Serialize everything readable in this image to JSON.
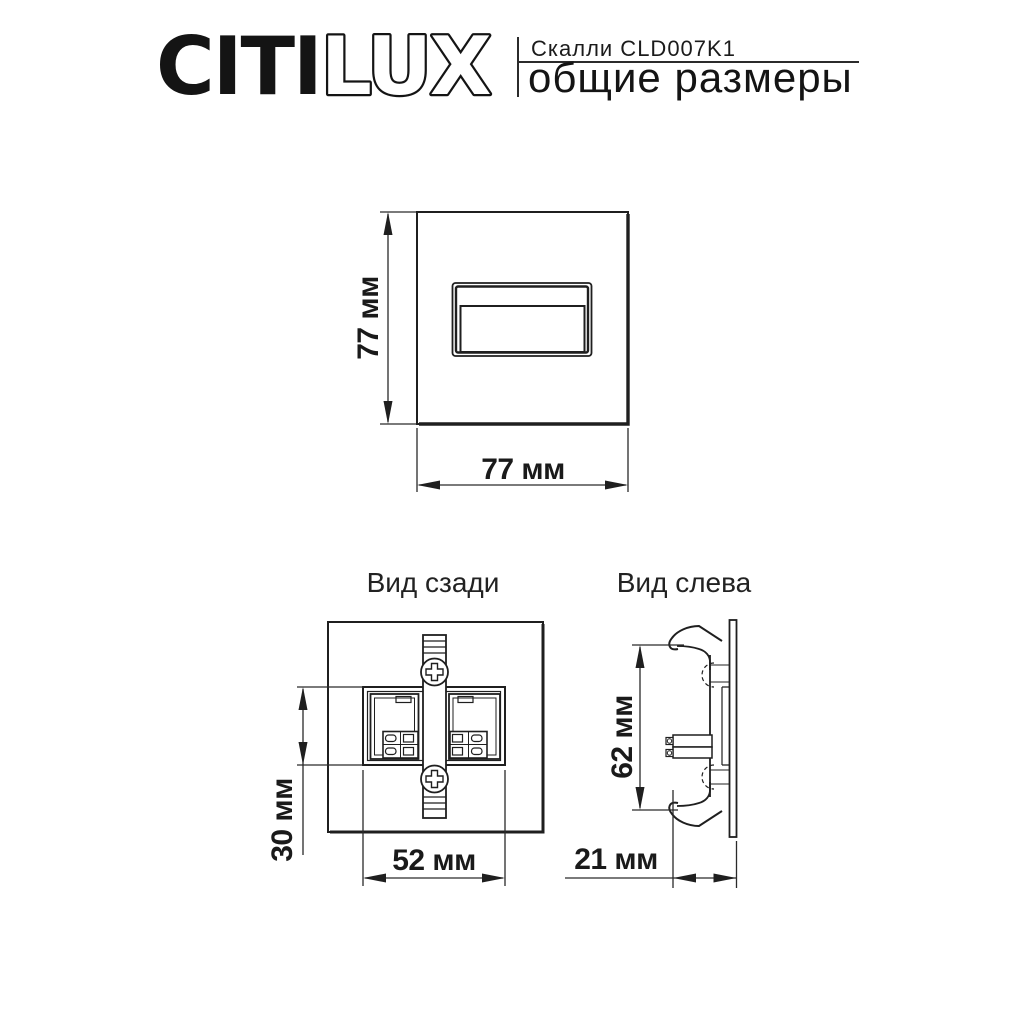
{
  "header": {
    "brand_part1": "CITI",
    "brand_part2": "LUX",
    "product": "Скалли CLD007K1",
    "subtitle": "общие размеры"
  },
  "front_view": {
    "height": "77 мм",
    "width": "77 мм"
  },
  "rear_view": {
    "title": "Вид сзади",
    "box_height": "30 мм",
    "box_width": "52 мм"
  },
  "left_view": {
    "title": "Вид слева",
    "height": "62 мм",
    "depth": "21 мм"
  },
  "colors": {
    "line": "#1f1f1f",
    "background": "#ffffff"
  }
}
